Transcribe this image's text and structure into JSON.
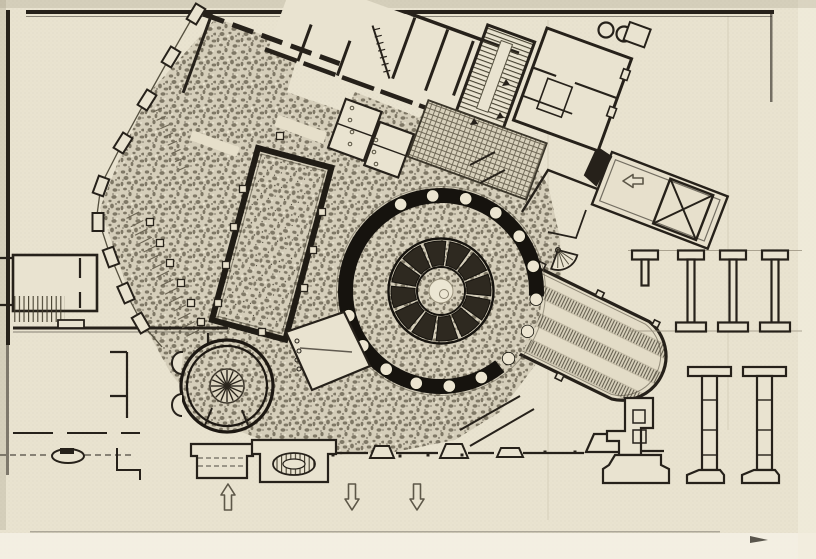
{
  "figure": {
    "kind": "scanned architectural floor plan print",
    "contains_text": false
  },
  "colors": {
    "paper": "#e9e3d0",
    "paper_light": "#f3efe2",
    "margin_light": "#f6f2e6",
    "ink": "#26211a",
    "ink_dark": "#16130e",
    "ink_mid": "#55503f",
    "hatch": "#45402f",
    "faint": "#a59d87",
    "stipple_bg": "#d5ceba",
    "stipple_blob": "#6f6857",
    "grid_line": "#6e6755"
  },
  "plan": {
    "rotunda": {
      "cx": 441,
      "cy": 291,
      "annulus_r": 101,
      "outer_line_r": 104.5,
      "ring_r": 95.5,
      "ring_w": 15,
      "ring_gap_start_deg": 3,
      "ring_gap_end_deg": 52,
      "columns": {
        "r": 6.2,
        "ring_r": 95.5,
        "start_deg": -15,
        "step_deg": 20,
        "count": 18,
        "skip_degs": [
          5,
          25,
          45
        ]
      },
      "segments": {
        "count": 12,
        "outer_r": 50,
        "inner_r": 26,
        "gap_deg": 5,
        "offset_deg": 8
      },
      "seg_outer_circle_r": 52.5,
      "seg_inner_circle_r": 24,
      "center": {
        "disc_r": 23,
        "white_r": 12,
        "small_r": 4.5,
        "small_dx": 3,
        "small_dy": 3
      }
    },
    "small_rotunda": {
      "cx": 227,
      "cy": 386,
      "outer_r": 46,
      "inner_r": 40,
      "hub_r": 17,
      "core_r": 3.2,
      "spokes": {
        "count": 16,
        "r0": 3,
        "r1": 16
      }
    },
    "fan_niche": {
      "cx": 558,
      "cy": 250,
      "r": 20,
      "a0": 15,
      "a1": 110,
      "spokes": 4,
      "dot_r": 2.4
    },
    "street_arrows": [
      {
        "x": 228,
        "y": 498,
        "dir": "up"
      },
      {
        "x": 352,
        "y": 498,
        "dir": "down"
      },
      {
        "x": 417,
        "y": 498,
        "dir": "down"
      }
    ],
    "ramp_arrow": {
      "x": 634,
      "y": 181,
      "dir": "left"
    },
    "piers_row1": {
      "guide": {
        "x0": 628,
        "x1": 802,
        "y_top": 250.5,
        "y_bot": 331
      },
      "xs": [
        678,
        720,
        762
      ],
      "flange_w": 26,
      "flange_h": 9,
      "stem_w": 7,
      "stem_h": 63,
      "partial": {
        "x": 632,
        "stem_h": 26
      }
    },
    "piers_row2": {
      "y_top": 367,
      "xs": [
        688,
        743
      ],
      "flange_w": 43,
      "flange_h": 9,
      "stem_w": 15,
      "stem_h": 94,
      "tick_ys": [
        400,
        430,
        455
      ],
      "base_w": 37,
      "base_h": 13
    },
    "pool_squares": [
      [
        243,
        189
      ],
      [
        234,
        227
      ],
      [
        226,
        265
      ],
      [
        218,
        303
      ],
      [
        322,
        212
      ],
      [
        313,
        250
      ],
      [
        304,
        288
      ],
      [
        280,
        136
      ],
      [
        262,
        332
      ]
    ],
    "colonnade_squares": [
      [
        150,
        222
      ],
      [
        160,
        243
      ],
      [
        170,
        263
      ],
      [
        181,
        283
      ],
      [
        191,
        303
      ],
      [
        201,
        322
      ]
    ],
    "chain_blocks": [
      [
        196,
        14,
        31
      ],
      [
        171,
        57,
        31
      ],
      [
        147,
        100,
        32
      ],
      [
        123,
        143,
        32
      ],
      [
        101,
        186,
        20
      ],
      [
        98,
        222,
        0
      ],
      [
        111,
        257,
        -20
      ],
      [
        126,
        293,
        -24
      ],
      [
        141,
        323,
        -30
      ]
    ],
    "chain_path": "M199 6 L171 55 L147 98 L123 142 L101 185 L97 215 L110 255 L126 293 L143 325 L162 347",
    "combs": [
      {
        "x0": 139,
        "y0": 212,
        "x1": 199,
        "y1": 330,
        "count": 15,
        "len": 14
      },
      {
        "x0": 162,
        "y0": 108,
        "x1": 188,
        "y1": 166,
        "count": 8,
        "len": 10
      }
    ],
    "vestibule_circles": {
      "r": 2,
      "pts": [
        [
          297,
          341
        ],
        [
          299,
          351
        ],
        [
          297,
          360
        ],
        [
          299,
          369
        ]
      ]
    },
    "hypocaust_circles": {
      "r": 1.8,
      "pts": [
        [
          352,
          108
        ],
        [
          350,
          120
        ],
        [
          352,
          132
        ],
        [
          350,
          144
        ],
        [
          376,
          140
        ],
        [
          374,
          152
        ],
        [
          376,
          164
        ]
      ]
    },
    "facade_ticks": [
      [
        333,
        455
      ],
      [
        400,
        456
      ],
      [
        428,
        455
      ],
      [
        462,
        455
      ],
      [
        545,
        452
      ],
      [
        575,
        452
      ]
    ],
    "solid_marks": [
      [
        474,
        122
      ],
      [
        506,
        83
      ],
      [
        500,
        116
      ]
    ]
  }
}
